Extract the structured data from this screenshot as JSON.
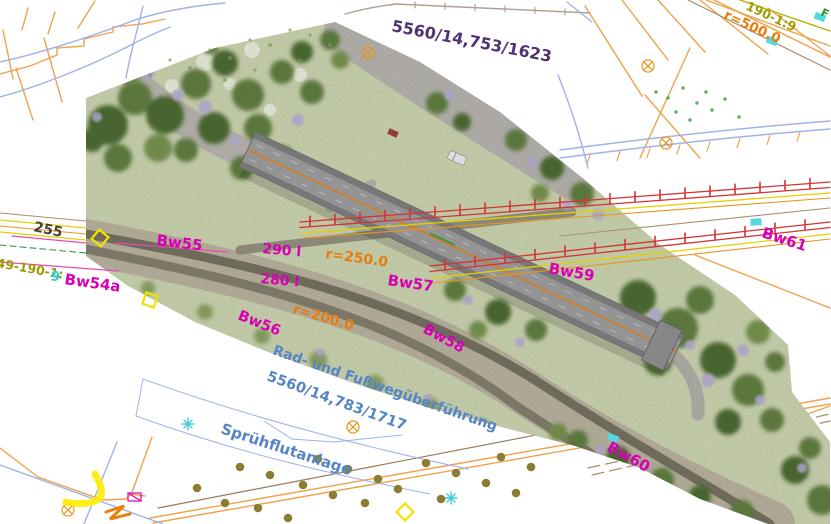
{
  "labels": {
    "parcel_upper": "5560/14,753/1623",
    "grade_upper_right": "190-1:9",
    "radius_500": "r=500.0",
    "edge_f": "F",
    "chainage_255": "255",
    "turnout_left": "49-190-1:",
    "turnout_left_point": "9",
    "bw54a": "Bw54a",
    "bw55": "Bw55",
    "signal_290": "290 l",
    "radius_250": "r=250.0",
    "signal_280": "280 l",
    "bw57": "Bw57",
    "bw59": "Bw59",
    "bw61": "Bw61",
    "bw56": "Bw56",
    "radius_200": "r=200.0",
    "bw58": "Bw58",
    "overpass_line1": "Rad- und Fußwegüberführung",
    "overpass_line2": "5560/14,783/1717",
    "spray_plant": "Sprühflutanlage",
    "bw60": "Bw60"
  },
  "colors": {
    "structure_magenta": "#d800b4",
    "radius_orange": "#e87d0e",
    "parcel_purple": "#4e3273",
    "annotation_blue": "#5585c5",
    "turnout_olive": "#9c9c00",
    "chainage_dark": "#463f35",
    "point_cyan": "#2fd0dc",
    "tree_green": "#2a9a2a",
    "parcel_line_orange": "#efa24d",
    "road_line_blue": "#9fb2e8",
    "railway_red": "#d23434",
    "cable_yellow": "#e3d200",
    "marker_cyan": "#55d8e2",
    "sprinkler_olive": "#8d7d33",
    "highlight_yellow": "#ffec00"
  }
}
